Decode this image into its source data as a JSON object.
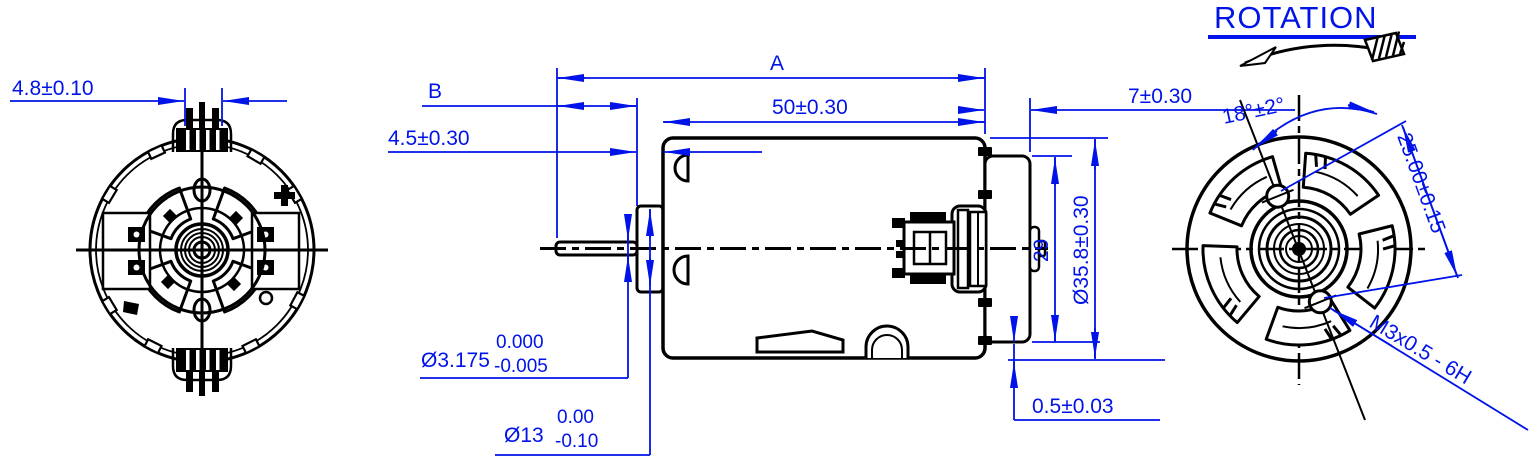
{
  "drawing": {
    "background": "#ffffff",
    "line_color": "#000000",
    "dimension_color": "#0013e8",
    "rear_view": {
      "terminal_width": "4.8±0.10"
    },
    "side_view": {
      "overall_length_label": "A",
      "shaft_length_label": "B",
      "body_length": "50±0.30",
      "boss_length": "4.5±0.30",
      "endcap_length": "7±0.30",
      "across_flats": "29",
      "body_diameter": "Ø35.8±0.30",
      "shaft_diameter": "Ø3.175",
      "shaft_tol_upper": "0.000",
      "shaft_tol_lower": "-0.005",
      "boss_diameter": "Ø13",
      "boss_tol_upper": "0.00",
      "boss_tol_lower": "-0.10",
      "endcap_step": "0.5±0.03"
    },
    "front_view": {
      "rotation_label": "ROTATION",
      "hole_angle": "18°±2°",
      "hole_pitch": "25.00±0.15",
      "mount_thread": "M3x0.5 - 6H"
    }
  }
}
